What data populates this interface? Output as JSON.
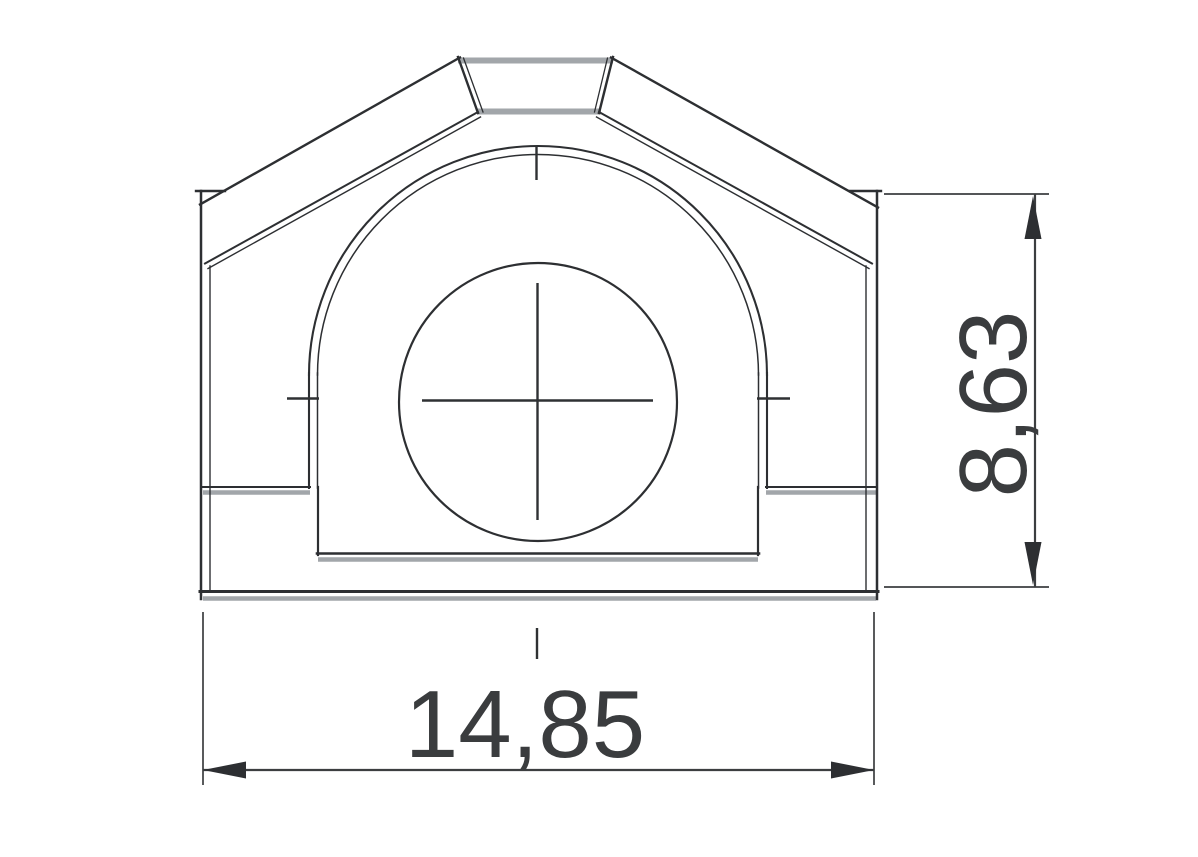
{
  "drawing": {
    "kind": "technical-cross-section",
    "features": {
      "outer_shape": "house-profile with flattened apex and short side walls",
      "inner_features": "semicircular dome cavity, central circle with crosshair centerline, stepped floor"
    }
  },
  "dimensions": {
    "width_label": "14,85",
    "height_label": "8,63"
  },
  "colors": {
    "line_dark": "#2d2f32",
    "line_soft": "#a2a6aa",
    "dim_line": "#3c3e40",
    "text": "#3a3c3e",
    "background": "#ffffff"
  }
}
